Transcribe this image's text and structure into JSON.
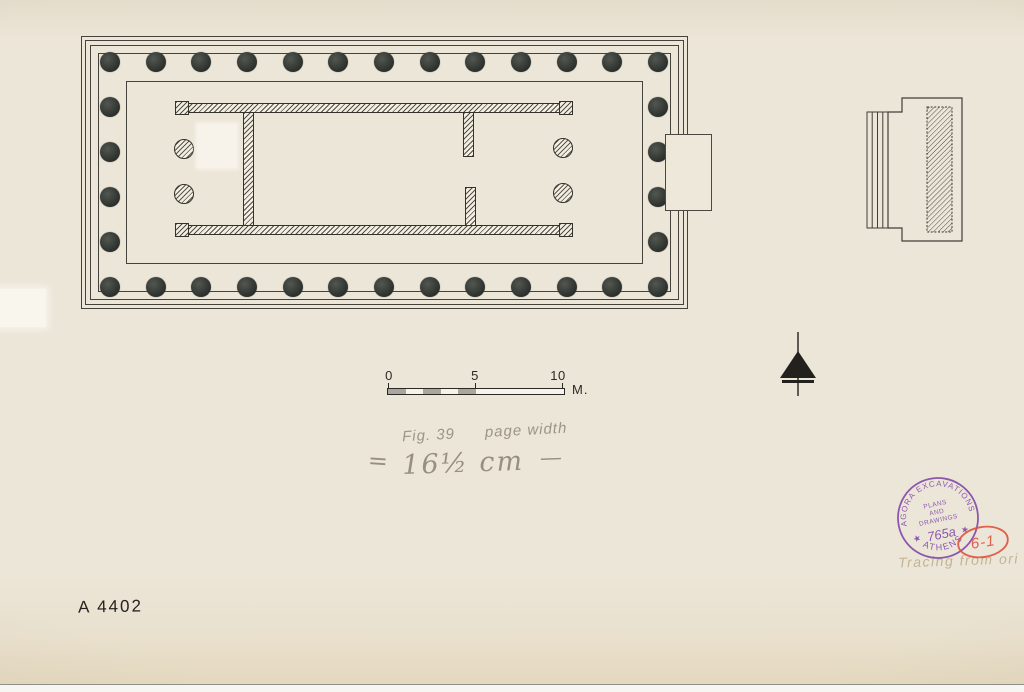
{
  "sheet": {
    "catalog_number": "A 4402",
    "tracing_note": "Tracing from ori",
    "colors": {
      "paper": "#ece6d8",
      "ink": "#35322c",
      "pencil": "#8e8777",
      "stamp_purple": "#7c3fa7",
      "red": "#e0523d"
    }
  },
  "fig_note": {
    "fig": "Fig. 39",
    "width_label": "page width",
    "equals": "=",
    "measurement": "16½ cm",
    "dash": "—"
  },
  "scalebar": {
    "tick_labels": [
      "0",
      "5",
      "10"
    ],
    "unit": "M.",
    "total_width": 176,
    "num_segments": 5,
    "segment_gray": "#aaa69b",
    "segment_white": "#f6f3ea"
  },
  "stamp": {
    "arc_top": "AGORA EXCAVATIONS",
    "arc_bottom": "★ ATHENS ★",
    "line1": "PLANS",
    "line2": "AND",
    "line3": "DRAWINGS",
    "number": "765a"
  },
  "red_code": {
    "text": "6-1"
  },
  "plan": {
    "x": 81,
    "y": 36,
    "width": 607,
    "height": 273,
    "border_insets": [
      0,
      4,
      9,
      17
    ],
    "floor_inset": 45,
    "peristyle": {
      "cols": 13,
      "rows": 6,
      "x0": 29,
      "x1": 577,
      "y0": 26,
      "y1": 251,
      "diameter": 20
    },
    "walls": [
      {
        "x": 94,
        "y": 67,
        "w": 398,
        "h": 10
      },
      {
        "x": 94,
        "y": 189,
        "w": 398,
        "h": 10
      },
      {
        "x": 162,
        "y": 76,
        "w": 11,
        "h": 114
      },
      {
        "x": 382,
        "y": 76,
        "w": 11,
        "h": 45
      },
      {
        "x": 384,
        "y": 151,
        "w": 11,
        "h": 39
      }
    ],
    "antae": [
      {
        "x": 94,
        "y": 65,
        "w": 14,
        "h": 14
      },
      {
        "x": 478,
        "y": 65,
        "w": 14,
        "h": 14
      },
      {
        "x": 94,
        "y": 187,
        "w": 14,
        "h": 14
      },
      {
        "x": 478,
        "y": 187,
        "w": 14,
        "h": 14
      }
    ],
    "porch_columns": [
      {
        "cx": 103,
        "cy": 113
      },
      {
        "cx": 103,
        "cy": 158
      },
      {
        "cx": 482,
        "cy": 112
      },
      {
        "cx": 482,
        "cy": 157
      }
    ],
    "porch_diameter": 20,
    "patch": {
      "x": 116,
      "y": 88,
      "w": 40,
      "h": 44
    }
  }
}
